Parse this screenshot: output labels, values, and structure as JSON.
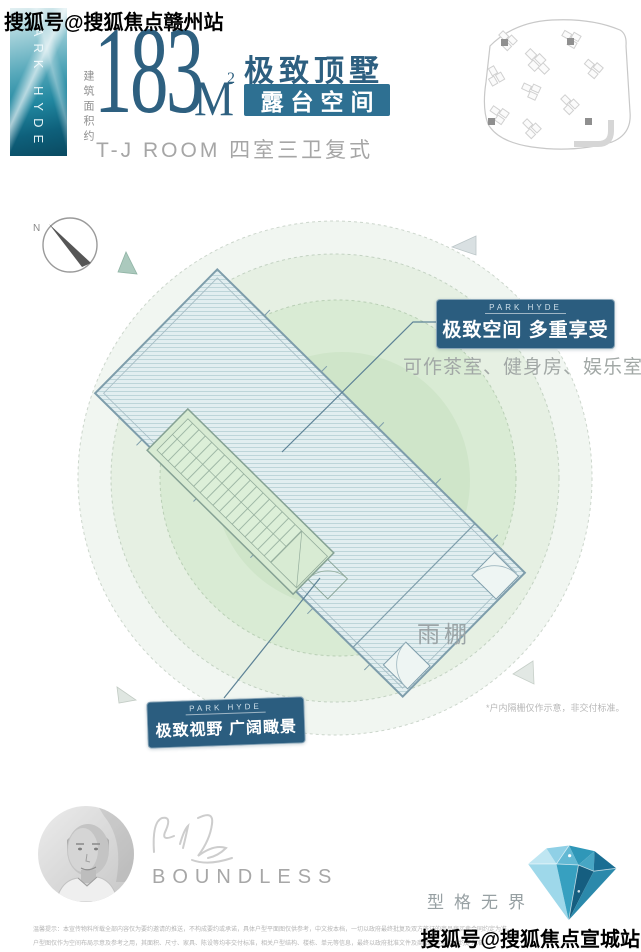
{
  "watermarks": {
    "top_left": "搜狐号@搜狐焦点赣州站",
    "bottom_right": "搜狐号@搜狐焦点宣城站"
  },
  "header": {
    "banner_vertical_text": "PARK HYDE",
    "area_prefix": "建筑面积约",
    "area_number": "183",
    "area_unit": "M",
    "area_unit_sup": "2",
    "headline": "极致顶墅",
    "subheadline": "露台空间",
    "type_line": "T-J ROOM 四室三卫复式"
  },
  "plan": {
    "compass_label": "N",
    "callout_top": {
      "brand": "PARK HYDE",
      "title": "极致空间 多重享受",
      "desc": "可作茶室、健身房、娱乐室等"
    },
    "callout_bottom": {
      "brand": "PARK HYDE",
      "title": "极致视野 广阔瞰景"
    },
    "canopy_label": "雨棚",
    "note": "*户内隔栅仅作示意，非交付标准。"
  },
  "footer": {
    "signature_name": "BOUNDLESS",
    "slogan": "型格无界",
    "disclaimer_line1": "温馨提示：本宣传物料所载全部内容仅为要约邀请的推送，不构成要约或承诺，具体户型平面图仅供参考，中文按本档，一切以政府最终批复及双方签订的商品房买卖合同约定为准。",
    "disclaimer_line2": "户型图仅作为空间布局示意及参考之用，其面积、尺寸、家具、陈设等均非交付标准，相关户型结构、楼栋、单元等信息，最终以政府批准文件及商品房买卖合同约定为准。"
  },
  "colors": {
    "accent_blue": "#2d5f80",
    "tag_teal": "#2e7092",
    "callout_bg": "#2b5d7f",
    "roof_fill": "#e2eef0",
    "circle_green": "#d9ebd4",
    "diamond_teal": "#2f97b8"
  }
}
